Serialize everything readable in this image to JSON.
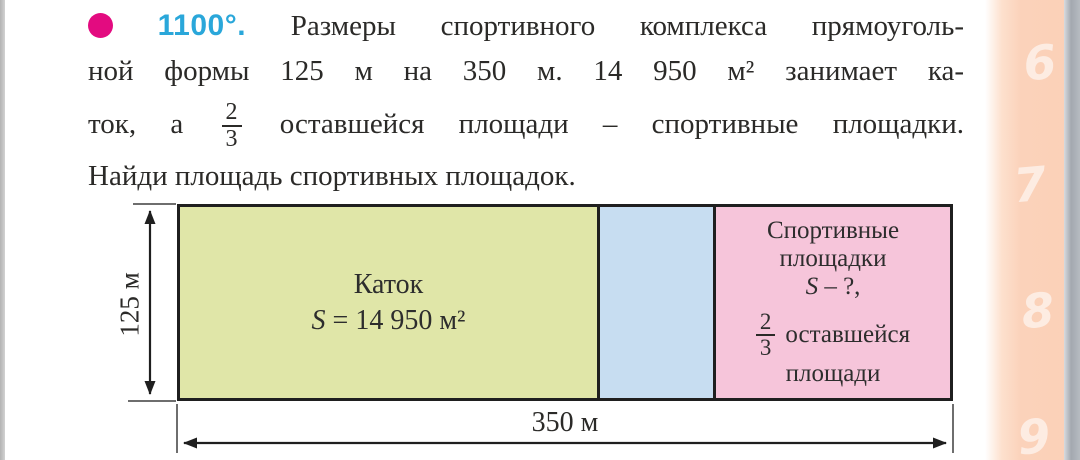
{
  "problem": {
    "number": "1100°.",
    "line1": "Размеры спортивного комплекса прямоуголь-",
    "line2": "ной формы 125 м на 350 м. 14 950 м² занимает ка-",
    "line3_before": "ток, а",
    "line3_frac_num": "2",
    "line3_frac_den": "3",
    "line3_after": "оставшейся площади – спортивные площадки.",
    "line4": "Найди площадь спортивных площадок."
  },
  "diagram": {
    "height_label": "125 м",
    "width_label": "350 м",
    "katok": {
      "title": "Каток",
      "s": "S",
      "s_eq": "= 14 950 м²"
    },
    "sports": {
      "line1": "Спортивные",
      "line2": "площадки",
      "s": "S",
      "s_rest": "– ?,",
      "frac_num": "2",
      "frac_den": "3",
      "frac_label": "оставшейся",
      "last_line": "площади"
    }
  },
  "page_edge": {
    "numbers": [
      "6",
      "7",
      "8",
      "9"
    ]
  },
  "colors": {
    "marker_magenta": "#e30b80",
    "number_cyan": "#2aa7da",
    "katok_fill": "#e0e6a8",
    "remaining_fill": "#c7ddf1",
    "sports_fill": "#f6c5da",
    "page_edge_peach": "#fbd0b7"
  }
}
